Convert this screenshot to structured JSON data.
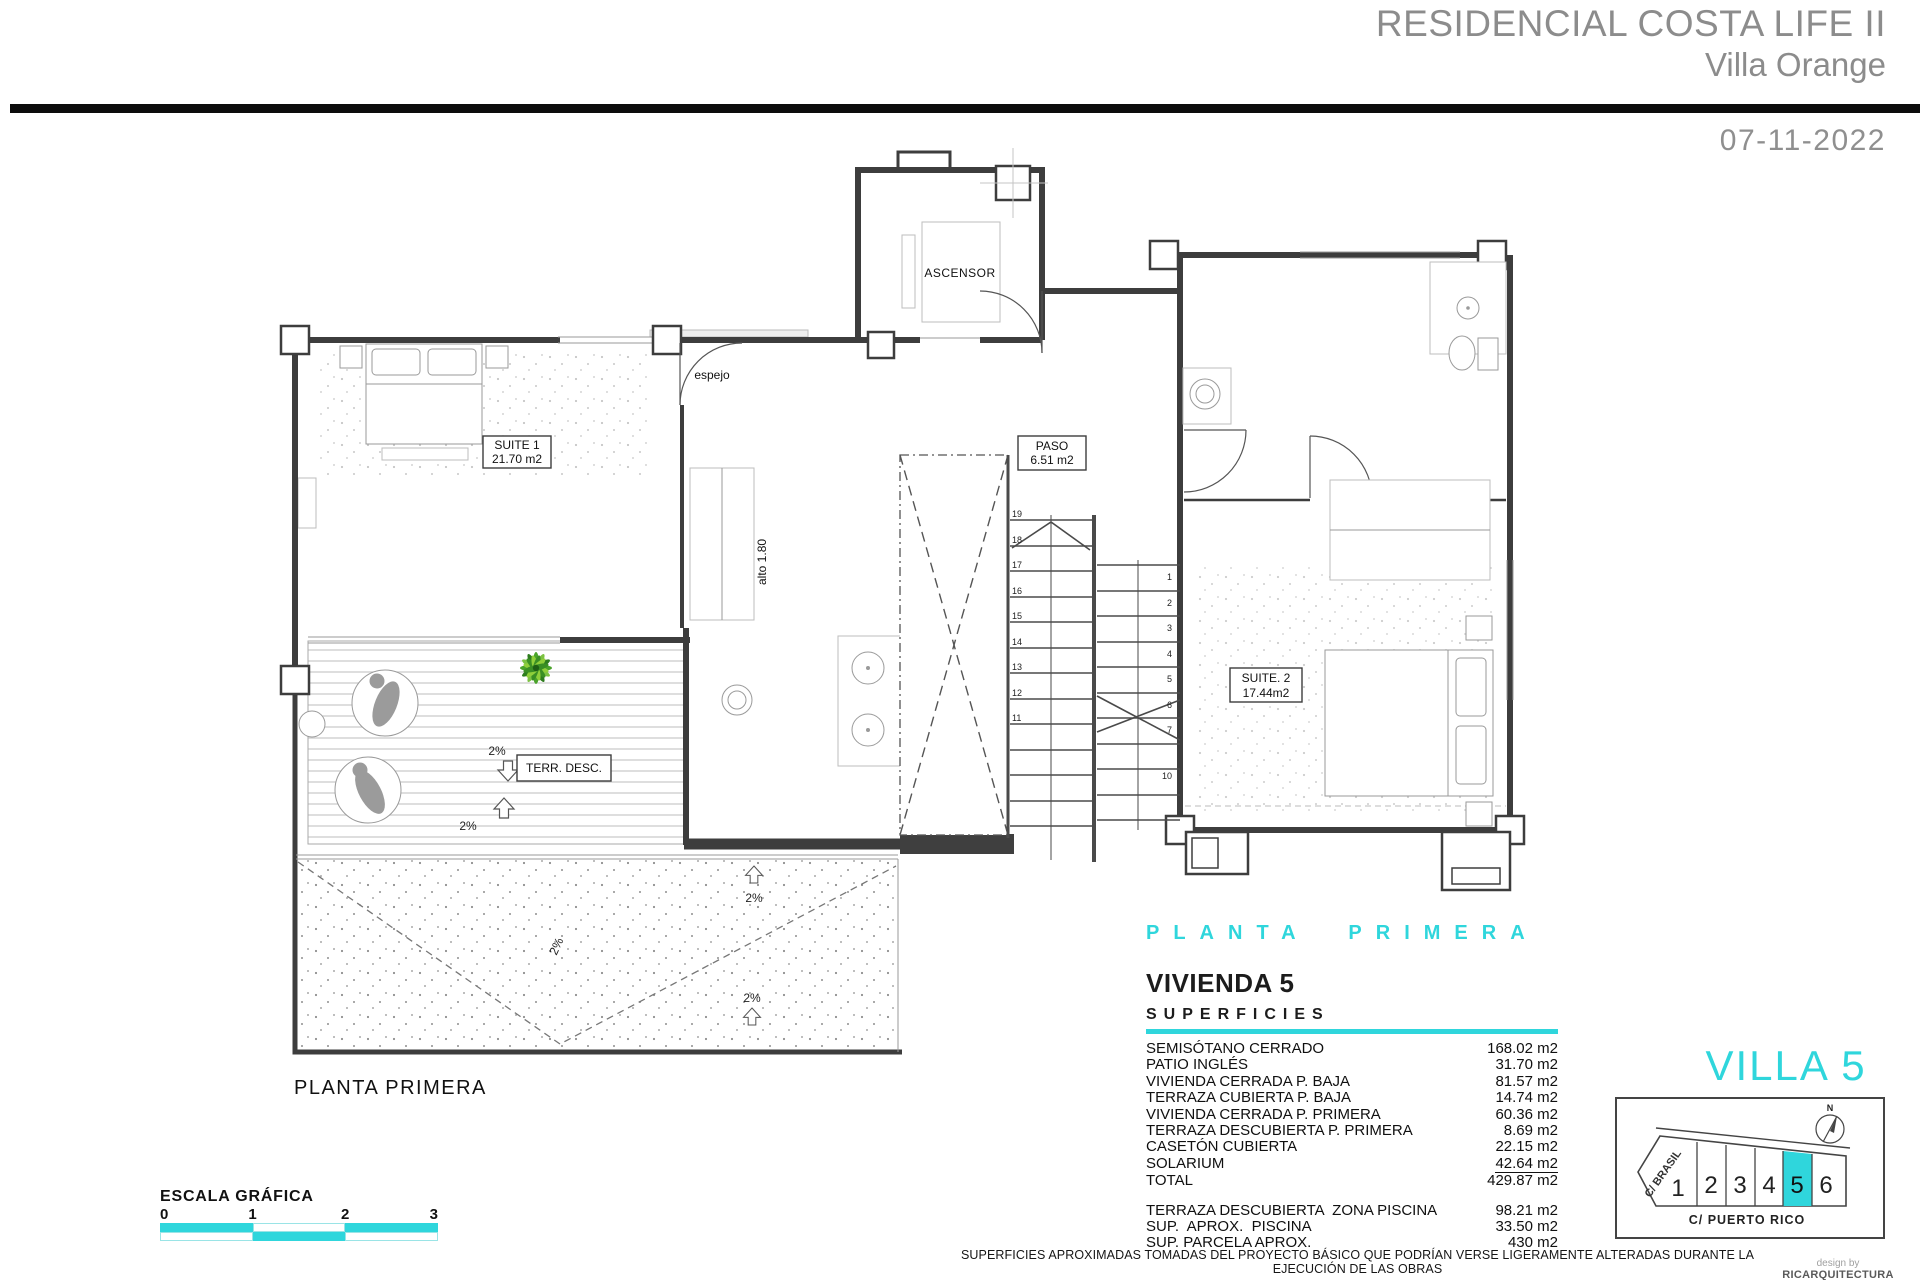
{
  "header": {
    "project_title": "RESIDENCIAL COSTA LIFE II",
    "project_subtitle": "Villa Orange",
    "date": "07-11-2022"
  },
  "plan": {
    "caption": "PLANTA PRIMERA",
    "labels": {
      "ascensor": "ASCENSOR",
      "espejo": "espejo",
      "alto": "alto 1.80",
      "suite1_name": "SUITE 1",
      "suite1_area": "21.70 m2",
      "paso_name": "PASO",
      "paso_area": "6.51 m2",
      "suite2_name": "SUITE. 2",
      "suite2_area": "17.44m2",
      "terraza": "TERR. DESC.",
      "slope": "2%"
    },
    "stairs": {
      "left": [
        "19",
        "18",
        "17",
        "16",
        "15",
        "14",
        "13",
        "12",
        "11"
      ],
      "right": [
        "1",
        "2",
        "3",
        "4",
        "5",
        "6",
        "7",
        "10"
      ]
    }
  },
  "summary": {
    "floor_heading": "PLANTA PRIMERA",
    "unit_title": "VIVIENDA 5",
    "section_title": "SUPERFICIES",
    "rows": [
      {
        "label": "SEMISÓTANO CERRADO",
        "value": "168.02 m2"
      },
      {
        "label": "PATIO INGLÉS",
        "value": "31.70 m2"
      },
      {
        "label": "VIVIENDA CERRADA P. BAJA",
        "value": "81.57 m2"
      },
      {
        "label": "TERRAZA CUBIERTA P. BAJA",
        "value": "14.74 m2"
      },
      {
        "label": "VIVIENDA CERRADA P. PRIMERA",
        "value": "60.36 m2"
      },
      {
        "label": "TERRAZA DESCUBIERTA P. PRIMERA",
        "value": "8.69 m2"
      },
      {
        "label": "CASETÓN CUBIERTA",
        "value": "22.15 m2"
      },
      {
        "label": "SOLARIUM",
        "value": "42.64 m2"
      },
      {
        "label": "TOTAL",
        "value": "429.87 m2"
      }
    ],
    "extra_rows": [
      {
        "label": "TERRAZA DESCUBIERTA  ZONA PISCINA",
        "value": "98.21 m2"
      },
      {
        "label": "SUP.  APROX.  PISCINA",
        "value": "33.50 m2"
      },
      {
        "label": "SUP. PARCELA APROX.",
        "value": "430 m2"
      }
    ]
  },
  "locator": {
    "title": "VILLA 5",
    "north_label": "N",
    "street_left": "C/ BRASIL",
    "street_bottom": "C/ PUERTO RICO",
    "plots": [
      "1",
      "2",
      "3",
      "4",
      "5",
      "6"
    ],
    "highlighted_plot": "5"
  },
  "scale_bar": {
    "title": "ESCALA GRÁFICA",
    "ticks": [
      "0",
      "1",
      "2",
      "3"
    ]
  },
  "footer": {
    "disclaimer": "SUPERFICIES APROXIMADAS TOMADAS DEL PROYECTO BÁSICO QUE PODRÍAN VERSE LIGERAMENTE ALTERADAS DURANTE LA EJECUCIÓN DE LAS OBRAS",
    "credit_top": "design by",
    "credit_bottom": "RICARQUITECTURA"
  },
  "colors": {
    "accent_cyan": "#2FD6DC",
    "heading_gray": "#8C8C8C",
    "wall_gray": "#3D3D3D"
  }
}
